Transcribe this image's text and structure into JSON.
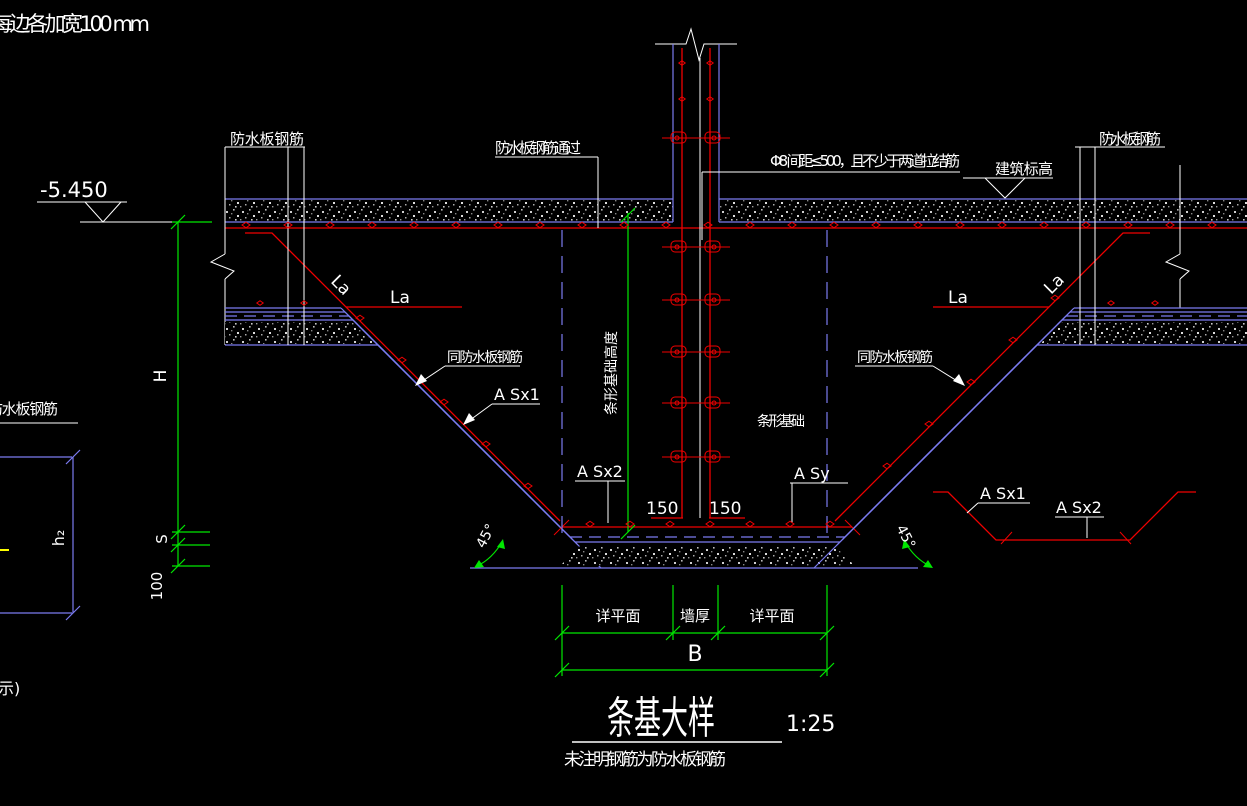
{
  "colors": {
    "bg": "#000000",
    "red": "#f00000",
    "blue": "#7b7bf0",
    "green": "#00e800",
    "white": "#ffffff",
    "yellow": "#ffff00"
  },
  "notes": {
    "top_left": "每边各加宽100 mm",
    "bottom_left_partial": "示)"
  },
  "elevations": {
    "left_value": "-5.450",
    "right_label": "建筑标高"
  },
  "rebar_labels": {
    "waterproof_left": "防水板钢筋",
    "waterproof_right": "防水板钢筋",
    "waterproof_pass": "防水板钢筋通过",
    "tie_note": "Φ8 间距≤500，且不少于两道拉结筋",
    "same_as_left": "同防水板钢筋",
    "same_as_right": "同防水板钢筋",
    "la_diag_left": "La",
    "la_horiz_left": "La",
    "la_horiz_right": "La",
    "la_diag_right": "La",
    "asx1": "A Sx1",
    "asx2": "A Sx2",
    "asy": "A Sy",
    "detail_asx1": "A Sx1",
    "detail_asx2": "A Sx2",
    "waterproof_small": "防水板钢筋"
  },
  "dimensions": {
    "H": "H",
    "S": "S",
    "cushion": "100",
    "h2": "h₂",
    "foundation_height": "条形基础高度",
    "foundation": "条形基础",
    "hook_left": "150",
    "hook_right": "150",
    "angle_left": "45°",
    "angle_right": "45°",
    "plan_left": "详平面",
    "wall_thickness": "墙厚",
    "plan_right": "详平面",
    "B": "B"
  },
  "title": {
    "text": "条基大样",
    "scale": "1:25",
    "note": "未注明钢筋为防水板钢筋"
  }
}
